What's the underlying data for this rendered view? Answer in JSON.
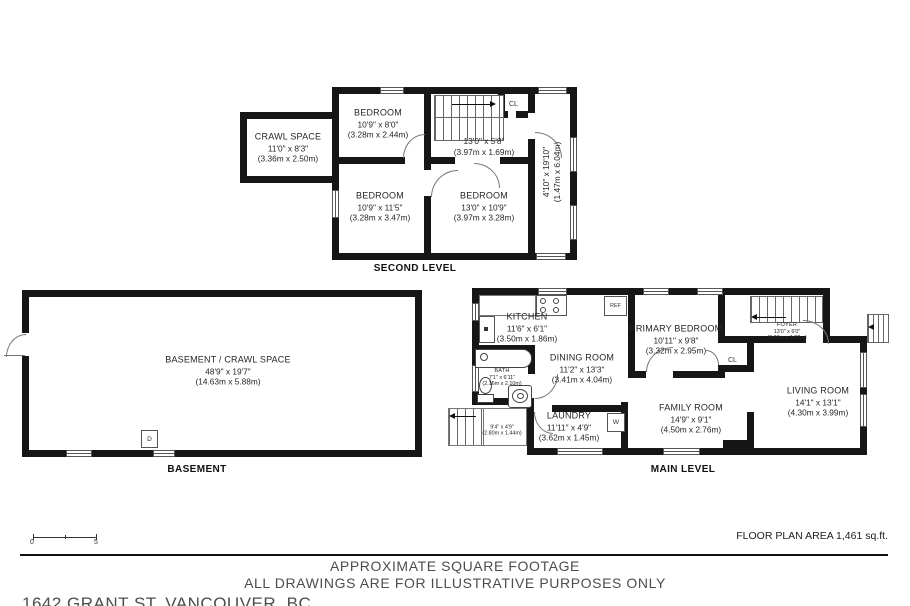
{
  "second_level": {
    "title": "SECOND LEVEL",
    "crawl_space": {
      "name": "CRAWL SPACE",
      "imperial": "11'0\" x 8'3\"",
      "metric": "(3.36m x 2.50m)"
    },
    "bedroom_top": {
      "name": "BEDROOM",
      "imperial": "10'9\" x 8'0\"",
      "metric": "(3.28m x 2.44m)"
    },
    "hall": {
      "imperial": "13'0\" x 5'8\"",
      "metric": "(3.97m x 1.69m)"
    },
    "bedroom_left": {
      "name": "BEDROOM",
      "imperial": "10'9\" x 11'5\"",
      "metric": "(3.28m x 3.47m)"
    },
    "bedroom_right": {
      "name": "BEDROOM",
      "imperial": "13'0\" x 10'9\"",
      "metric": "(3.97m x 3.28m)"
    },
    "side_room": {
      "imperial": "4'10\" x 19'10\"",
      "metric": "(1.47m x 6.04m)"
    },
    "closet": "CL"
  },
  "basement": {
    "title": "BASEMENT",
    "room": {
      "name": "BASEMENT / CRAWL SPACE",
      "imperial": "48'9\" x 19'7\"",
      "metric": "(14.63m x 5.88m)"
    },
    "door_marker": "D"
  },
  "main_level": {
    "title": "MAIN LEVEL",
    "kitchen": {
      "name": "KITCHEN",
      "imperial": "11'6\" x 6'1\"",
      "metric": "(3.50m x 1.86m)"
    },
    "dining": {
      "name": "DINING ROOM",
      "imperial": "11'2\" x 13'3\"",
      "metric": "(3.41m x 4.04m)"
    },
    "bath": {
      "name": "BATH",
      "imperial": "7'1\" x 6'11\"",
      "metric": "(2.16m x 2.10m)"
    },
    "laundry": {
      "name": "LAUNDRY",
      "imperial": "11'11\" x 4'9\"",
      "metric": "(3.62m x 1.45m)"
    },
    "stairs": {
      "imperial": "9'4\" x 4'9\"",
      "metric": "(2.80m x 1.44m)"
    },
    "primary_bedroom": {
      "name": "PRIMARY BEDROOM",
      "imperial": "10'11\" x 9'8\"",
      "metric": "(3.32m x 2.95m)"
    },
    "foyer": {
      "name": "FOYER",
      "imperial": "13'0\" x 6'0\"",
      "metric": "(3.97m x 1.82m)"
    },
    "family": {
      "name": "FAMILY ROOM",
      "imperial": "14'9\" x 9'1\"",
      "metric": "(4.50m x 2.76m)"
    },
    "living": {
      "name": "LIVING ROOM",
      "imperial": "14'1\" x 13'1\"",
      "metric": "(4.30m x 3.99m)"
    },
    "closet": "CL",
    "fridge": "REF",
    "washer": "W"
  },
  "footer": {
    "scale_zero": "0",
    "scale_five": "5",
    "area_label": "FLOOR PLAN AREA 1,461 sq.ft.",
    "disclaimer_line1": "APPROXIMATE SQUARE FOOTAGE",
    "disclaimer_line2": "ALL DRAWINGS ARE FOR ILLUSTRATIVE PURPOSES ONLY",
    "address": "1642 GRANT ST, VANCOUVER, BC"
  }
}
